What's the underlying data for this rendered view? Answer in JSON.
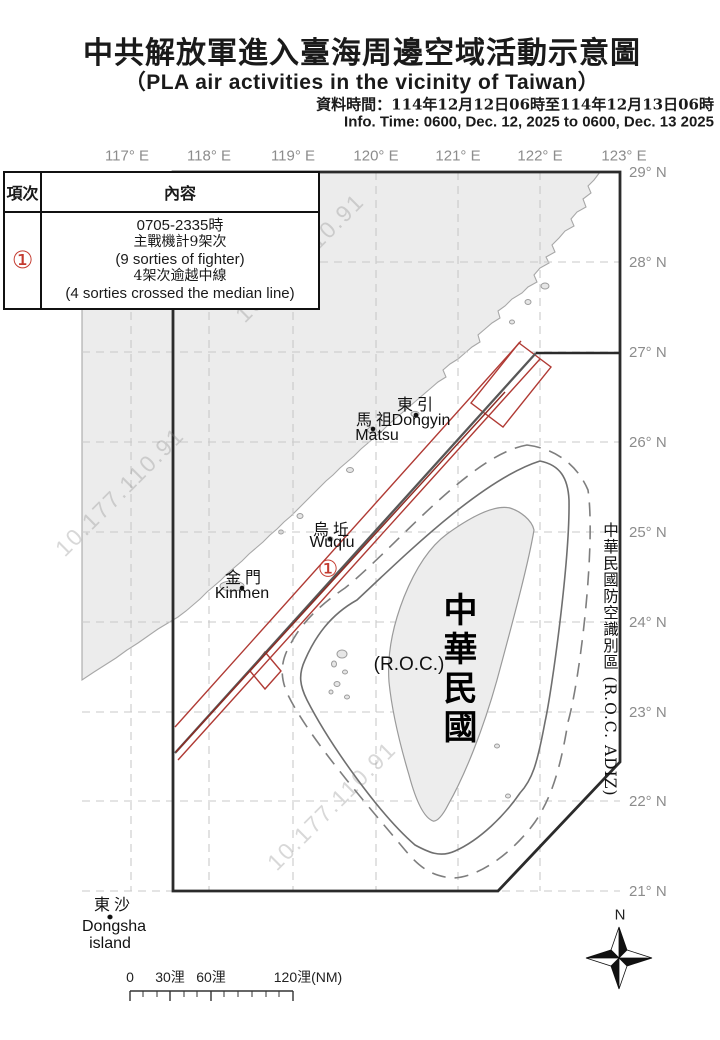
{
  "header": {
    "title_zh": "中共解放軍進入臺海周邊空域活動示意圖",
    "title_en": "（PLA air activities in the vicinity of Taiwan）",
    "data_time_zh": "資料時間：114年12月12日06時至114年12月13日06時",
    "info_time_en": "Info. Time: 0600, Dec. 12, 2025 to 0600, Dec. 13 2025"
  },
  "legend_table": {
    "col_item": "項次",
    "col_content": "內容",
    "row_no": "①",
    "row_lines": [
      "0705-2335時",
      "主戰機計9架次",
      "(9 sorties of fighter)",
      "4架次逾越中線",
      "(4 sorties crossed the median line)"
    ]
  },
  "map": {
    "lon_labels": [
      "117° E",
      "118° E",
      "119° E",
      "120° E",
      "121° E",
      "122° E",
      "123° E"
    ],
    "lat_labels": [
      "29° N",
      "28° N",
      "27° N",
      "26° N",
      "25° N",
      "24° N",
      "23° N",
      "22° N",
      "21° N"
    ],
    "dongyin_zh": "東引",
    "dongyin_en": "Dongyin",
    "matsu_zh": "馬祖",
    "matsu_en": "Matsu",
    "wuqiu_zh": "烏坵",
    "wuqiu_en": "Wuqiu",
    "kinmen_zh": "金門",
    "kinmen_en": "Kinmen",
    "dongsha_zh": "東沙",
    "dongsha_en": "Dongsha",
    "dongsha_en2": "island",
    "taiwan_zh": "中華民國",
    "taiwan_en": "(R.O.C.)",
    "adiz_label": "中華民國防空識別區 (R.O.C. ADIZ)",
    "marker_1": "①",
    "watermark": "10.177.110.91",
    "compass_n": "N"
  },
  "scalebar": {
    "labels": [
      "0",
      "30浬",
      "60浬",
      "120浬(NM)"
    ]
  },
  "colors": {
    "accent_red": "#b03a34",
    "marker_red": "#c43a2f",
    "boundary_dark": "#2b2b2b",
    "median_maroon": "#7a2e28",
    "land_gray": "#ececec",
    "line_gray": "#7a7a7a",
    "grid_gray": "#c9c9c9",
    "label_gray": "#8c8c8c"
  }
}
